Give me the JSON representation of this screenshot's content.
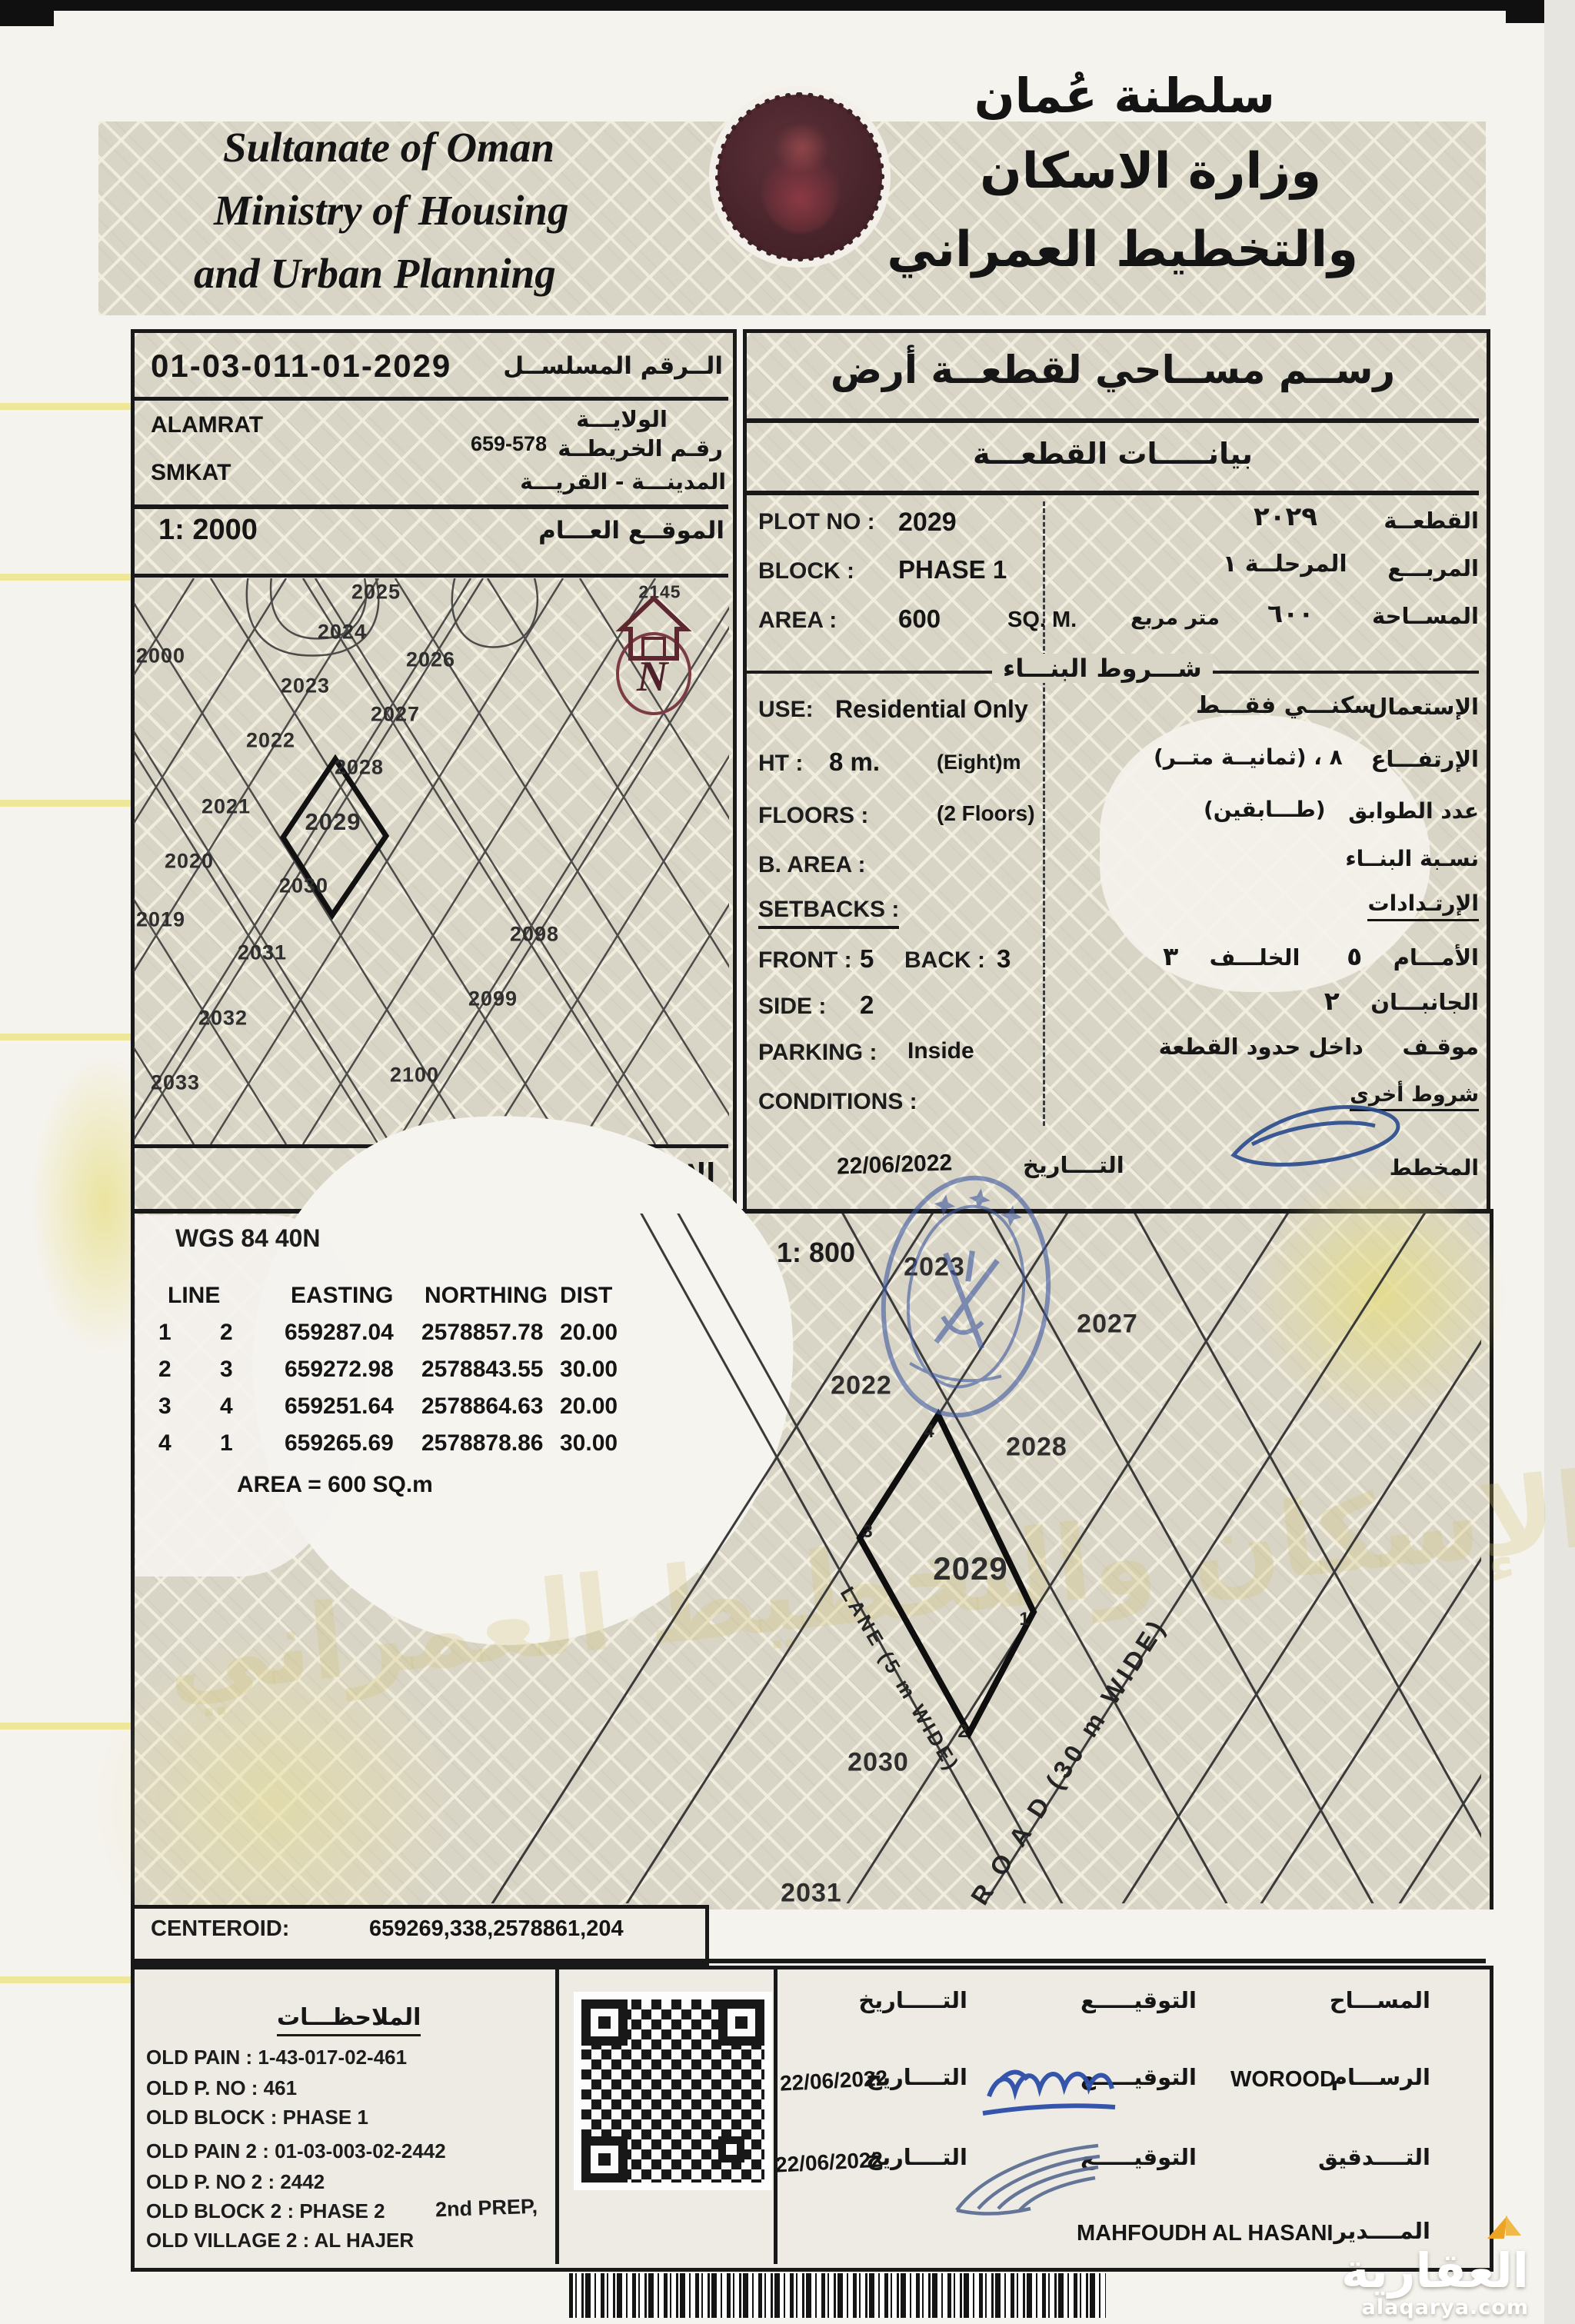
{
  "header": {
    "en1": "Sultanate of Oman",
    "en2": "Ministry of Housing",
    "en3": "and Urban Planning",
    "ar1": "سلطنة عُمان",
    "ar2": "وزارة الاسكان",
    "ar3": "والتخطيط العمراني"
  },
  "serial": {
    "value": "01-03-011-01-2029",
    "label_ar": "الــرقم المسلســل"
  },
  "location": {
    "wilaya": "ALAMRAT",
    "wilaya_label_ar": "الولايـــة",
    "map_no": "659-578",
    "map_no_label_ar": "رقـم الخريطــة",
    "village": "SMKAT",
    "village_label_ar": "المدينـــة - القريـــة"
  },
  "overview": {
    "scale": "1: 2000",
    "scale_label_ar": "الموقــع العـــام",
    "projection_label_ar": "الإســـقاط",
    "north": "N",
    "plot_2145": "2145",
    "plots": {
      "2000": "2000",
      "2019": "2019",
      "2020": "2020",
      "2021": "2021",
      "2022": "2022",
      "2023": "2023",
      "2024": "2024",
      "2025": "2025",
      "2026": "2026",
      "2027": "2027",
      "2028": "2028",
      "2029": "2029",
      "2030": "2030",
      "2031": "2031",
      "2032": "2032",
      "2033": "2033",
      "2098": "2098",
      "2099": "2099",
      "2100": "2100"
    }
  },
  "survey": {
    "title_ar": "رســم مســاحي لقطعــة أرض",
    "subtitle_ar": "بيانـــــات القطعـــة",
    "plot_label": "PLOT NO :",
    "plot_value": "2029",
    "plot_value_ar": "٢٠٢٩",
    "plot_label_ar": "القطعــة",
    "block_label": "BLOCK :",
    "block_value": "PHASE 1",
    "block_value_ar": "المرحلــة ١",
    "block_label_ar": "المربـــع",
    "area_label": "AREA :",
    "area_value": "600",
    "area_unit": "SQ. M.",
    "area_unit_ar": "متر مربع",
    "area_value_ar": "٦٠٠",
    "area_label_ar": "المســاحة",
    "building_header_ar": "شـــروط البنـــاء"
  },
  "cond": {
    "use_label": "USE:",
    "use_value": "Residential Only",
    "use_value_ar": "سكنـــي فقـــط",
    "use_label_ar": "الإستعمال",
    "ht_label": "HT :",
    "ht_value": "8 m.",
    "ht_note": "(Eight)m",
    "ht_value_ar": "٨ ، (ثمانيــة متــر)",
    "ht_label_ar": "الإرتفـــاع",
    "floors_label": "FLOORS :",
    "floors_value": "(2 Floors)",
    "floors_value_ar": "(طـــابقين)",
    "floors_label_ar": "عدد الطوابق",
    "barea_label": "B. AREA :",
    "barea_label_ar": "نسـبة البنــاء",
    "setbacks_label": "SETBACKS :",
    "setbacks_label_ar": "الإرتـدادات",
    "front_label": "FRONT :",
    "front_value": "5",
    "back_label": "BACK :",
    "back_value": "3",
    "front_label_ar": "الأمـــام",
    "front_value_ar": "٥",
    "back_label_ar": "الخلـــف",
    "back_value_ar": "٣",
    "side_label": "SIDE :",
    "side_value": "2",
    "side_label_ar": "الجانبـــان",
    "side_value_ar": "٢",
    "parking_label": "PARKING :",
    "parking_value": "Inside",
    "parking_label_ar": "موقـف",
    "parking_value_ar": "داخل حدود القطعة",
    "conditions_label": "CONDITIONS :",
    "conditions_label_ar": "شروط أخرى",
    "date": "22/06/2022",
    "date_label_ar": "التــــاريخ",
    "planner_label_ar": "المخطط"
  },
  "geo": {
    "datum": "WGS 84  40N",
    "scale_detail": "1: 800",
    "h_line": "LINE",
    "h_east": "EASTING",
    "h_north": "NORTHING",
    "h_dist": "DIST",
    "rows": [
      [
        "1",
        "2",
        "659287.04",
        "2578857.78",
        "20.00"
      ],
      [
        "2",
        "3",
        "659272.98",
        "2578843.55",
        "30.00"
      ],
      [
        "3",
        "4",
        "659251.64",
        "2578864.63",
        "20.00"
      ],
      [
        "4",
        "1",
        "659265.69",
        "2578878.86",
        "30.00"
      ]
    ],
    "area_eq": "AREA = 600  SQ.m",
    "centeroid_label": "CENTEROID:",
    "centeroid_value": "659269,338,2578861,204"
  },
  "dmap": {
    "p2023": "2023",
    "p2027": "2027",
    "p2022": "2022",
    "p2028": "2028",
    "p2029": "2029",
    "p2030": "2030",
    "p2031": "2031",
    "c1": "1",
    "c2": "2",
    "c3": "3",
    "c4": "4",
    "lane": "LANE (5 m WIDE)",
    "road": "R O A D  (30 m WIDE)"
  },
  "notes": {
    "header_ar": "الملاحظـــات",
    "l1": "OLD PAIN : 1-43-017-02-461",
    "l2": "OLD P. NO : 461",
    "l3": "OLD BLOCK : PHASE 1",
    "l4": "OLD PAIN 2 : 01-03-003-02-2442",
    "l5": "OLD P. NO 2 : 2442",
    "l6": "OLD BLOCK 2 : PHASE 2",
    "l7": "OLD VILLAGE 2 : AL HAJER",
    "prep": "2nd PREP,"
  },
  "sign": {
    "r1_role": "المســـاح",
    "r1_sig": "التوقيـــــع",
    "r1_date_lbl": "التـــــاريخ",
    "r2_role": "الرســـام",
    "r2_name": "WOROOD",
    "r2_sig": "التوقيـــــع",
    "r2_date_lbl": "التــــاريخ",
    "r2_date": "22/06/2022",
    "r3_role": "التــــدقيق",
    "r3_sig": "التوقيـــــع",
    "r3_date_lbl": "التــــاريخ",
    "r3_date": "22/06/2022",
    "r4_role": "المــــدير",
    "r4_name": "MAHFOUDH AL HASANI"
  },
  "ghost": {
    "g1": "وزارة الإسكان والتخطيط العمراني",
    "g2": "سلطنة عمان"
  },
  "brand": {
    "name_ar": "العقارية",
    "domain": "alaqarya.com"
  },
  "colors": {
    "stamp": "#3e57a0",
    "seal": "#4a262c",
    "accent": "#e8a51f",
    "pattern": "#d8d4c5",
    "ink": "#1d1d1d"
  }
}
